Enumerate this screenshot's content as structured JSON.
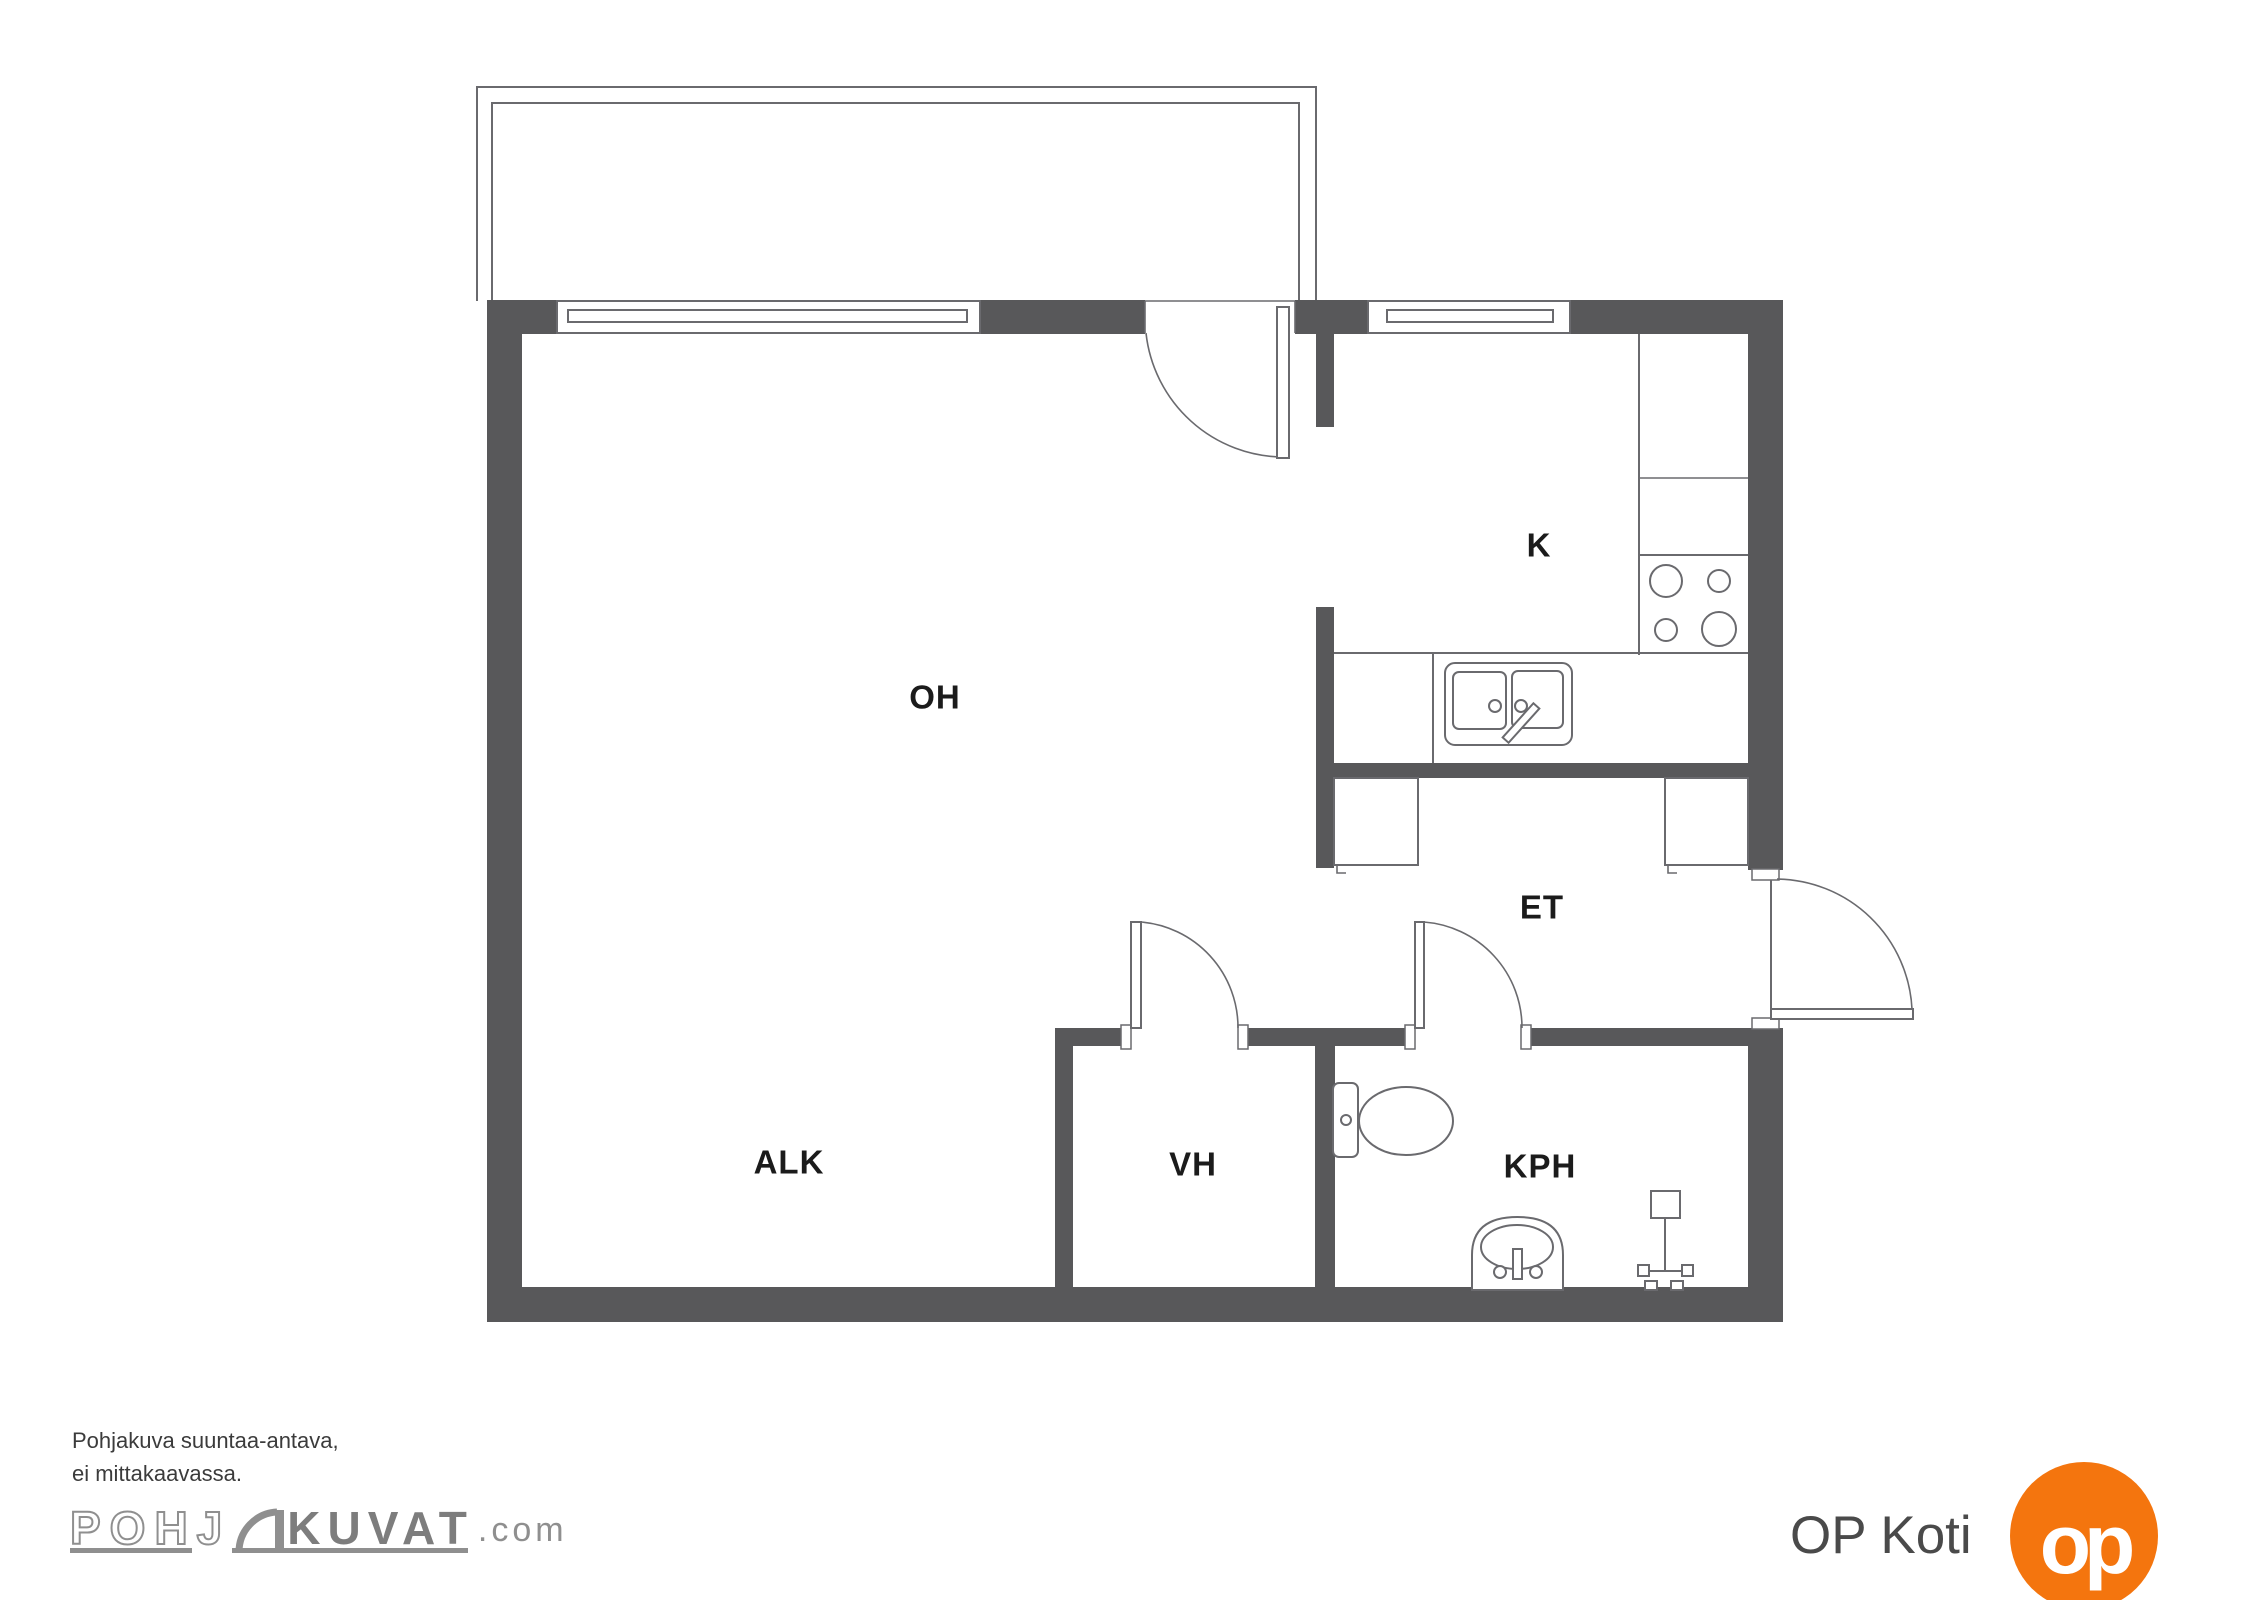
{
  "plan": {
    "rooms": {
      "living": "OH",
      "kitchen": "K",
      "entry": "ET",
      "alcove": "ALK",
      "closet": "VH",
      "bathroom": "KPH"
    }
  },
  "footer": {
    "disclaimer_line1": "Pohjakuva suuntaa-antava,",
    "disclaimer_line2": "ei mittakaavassa.",
    "logo_part1": "POHJ",
    "logo_part2": "KUVAT",
    "logo_suffix": ".com"
  },
  "branding": {
    "op_label": "OP Koti",
    "op_monogram": "op"
  },
  "colors": {
    "wall": "#58585a",
    "line": "#6a6a6e",
    "room_label": "#1b1b1b",
    "logo_gray": "#8f8f8f",
    "op_orange": "#f4750e"
  }
}
